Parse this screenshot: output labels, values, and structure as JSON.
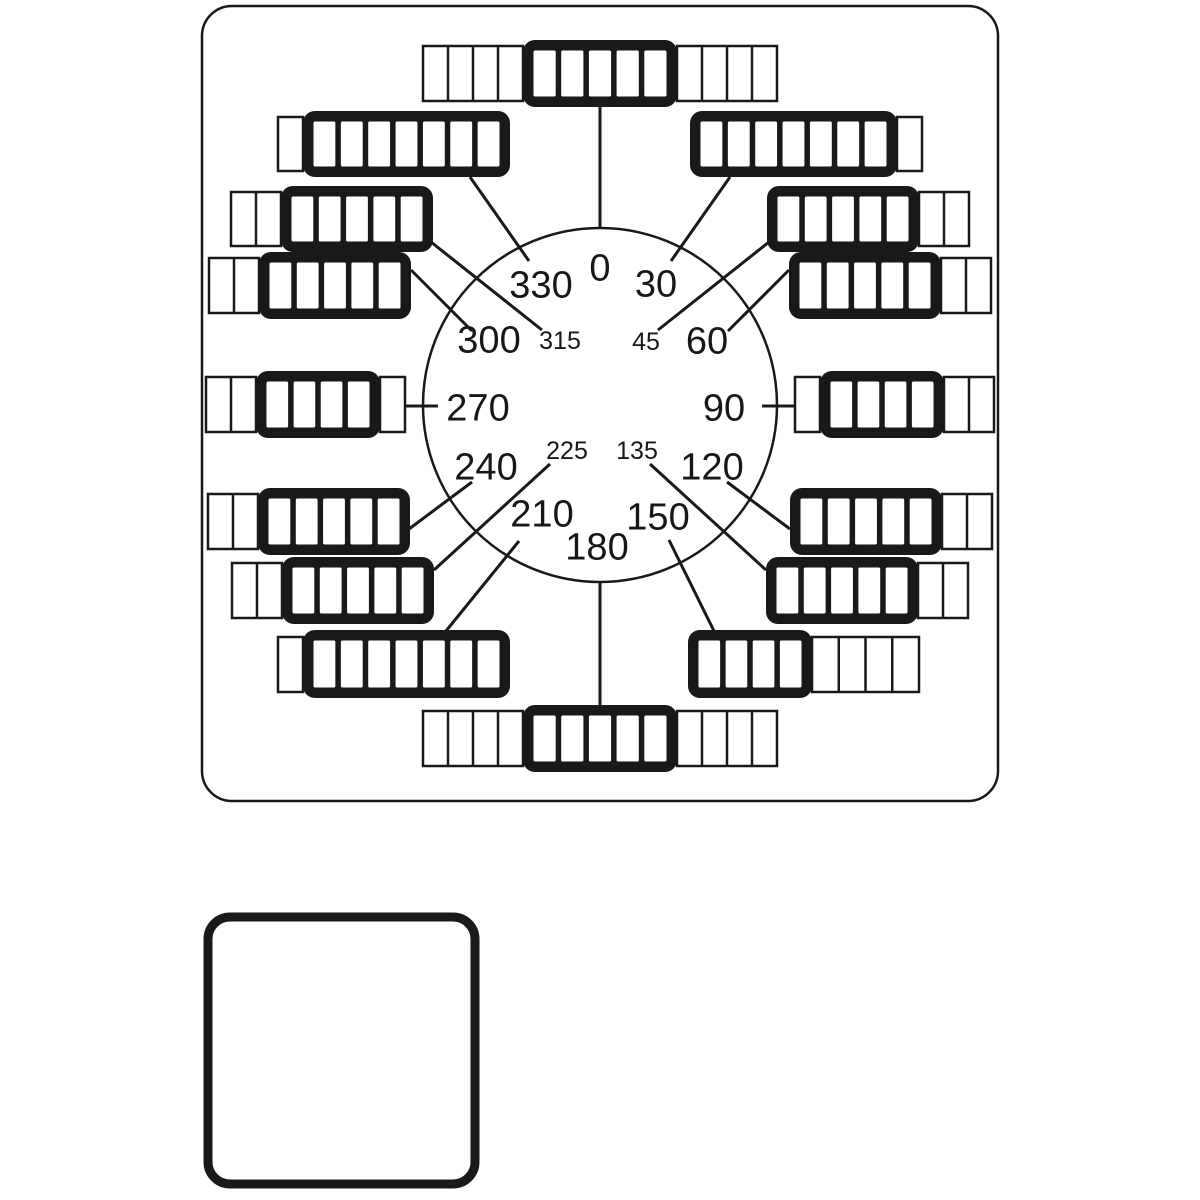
{
  "diagram": {
    "name": "rotary-cam-switch-faceplate-dial",
    "colors": {
      "ink": "#191919",
      "background": "#ffffff"
    },
    "panel": {
      "x": 202,
      "y": 6,
      "w": 796,
      "h": 795,
      "r": 30,
      "stroke_w": 2.5
    },
    "dial_circle": {
      "cx": 600,
      "cy": 405,
      "r": 177,
      "stroke_w": 2.5
    },
    "legend_square": {
      "x": 208,
      "y": 917,
      "w": 267,
      "h": 267,
      "r": 22,
      "stroke_w": 9
    },
    "positions": [
      {
        "angle": "0",
        "label": {
          "x": 600,
          "y": 267,
          "size": "large"
        },
        "line": {
          "x1": 600,
          "y1": 107,
          "x2": 600,
          "y2": 228
        },
        "segments": [
          {
            "style": "thin",
            "x": 423,
            "y": 46,
            "w": 100,
            "h": 55,
            "cells": 4
          },
          {
            "style": "thick",
            "x": 523,
            "y": 40,
            "w": 154,
            "h": 67,
            "cells": 5
          },
          {
            "style": "thin",
            "x": 677,
            "y": 46,
            "w": 100,
            "h": 55,
            "cells": 4
          }
        ]
      },
      {
        "angle": "30",
        "label": {
          "x": 656,
          "y": 283,
          "size": "large"
        },
        "line": {
          "x1": 730,
          "y1": 177,
          "x2": 671,
          "y2": 261
        },
        "segments": [
          {
            "style": "thick",
            "x": 690,
            "y": 111,
            "w": 207,
            "h": 66,
            "cells": 7
          },
          {
            "style": "thin",
            "x": 897,
            "y": 117,
            "w": 25,
            "h": 54,
            "cells": 1
          }
        ]
      },
      {
        "angle": "45",
        "label": {
          "x": 646,
          "y": 341,
          "size": "small"
        },
        "line": {
          "x1": 769,
          "y1": 242,
          "x2": 658,
          "y2": 330
        },
        "segments": [
          {
            "style": "thick",
            "x": 767,
            "y": 186,
            "w": 152,
            "h": 66,
            "cells": 5
          },
          {
            "style": "thin",
            "x": 919,
            "y": 192,
            "w": 50,
            "h": 54,
            "cells": 2
          }
        ]
      },
      {
        "angle": "60",
        "label": {
          "x": 707,
          "y": 340,
          "size": "large"
        },
        "line": {
          "x1": 789,
          "y1": 270,
          "x2": 728,
          "y2": 331
        },
        "segments": [
          {
            "style": "thick",
            "x": 789,
            "y": 252,
            "w": 152,
            "h": 67,
            "cells": 5
          },
          {
            "style": "thin",
            "x": 941,
            "y": 258,
            "w": 50,
            "h": 55,
            "cells": 2
          }
        ]
      },
      {
        "angle": "90",
        "label": {
          "x": 724,
          "y": 407,
          "size": "large"
        },
        "line": {
          "x1": 762,
          "y1": 406,
          "x2": 797,
          "y2": 406
        },
        "segments": [
          {
            "style": "thin",
            "x": 795,
            "y": 377,
            "w": 25,
            "h": 55,
            "cells": 1
          },
          {
            "style": "thick",
            "x": 820,
            "y": 371,
            "w": 124,
            "h": 67,
            "cells": 4
          },
          {
            "style": "thin",
            "x": 944,
            "y": 377,
            "w": 50,
            "h": 55,
            "cells": 2
          }
        ]
      },
      {
        "angle": "120",
        "label": {
          "x": 712,
          "y": 466,
          "size": "large"
        },
        "line": {
          "x1": 790,
          "y1": 529,
          "x2": 727,
          "y2": 482
        },
        "segments": [
          {
            "style": "thick",
            "x": 790,
            "y": 488,
            "w": 152,
            "h": 67,
            "cells": 5
          },
          {
            "style": "thin",
            "x": 942,
            "y": 494,
            "w": 50,
            "h": 55,
            "cells": 2
          }
        ]
      },
      {
        "angle": "135",
        "label": {
          "x": 637,
          "y": 450,
          "size": "small"
        },
        "line": {
          "x1": 766,
          "y1": 570,
          "x2": 650,
          "y2": 464
        },
        "segments": [
          {
            "style": "thick",
            "x": 766,
            "y": 557,
            "w": 152,
            "h": 67,
            "cells": 5
          },
          {
            "style": "thin",
            "x": 918,
            "y": 563,
            "w": 50,
            "h": 55,
            "cells": 2
          }
        ]
      },
      {
        "angle": "150",
        "label": {
          "x": 658,
          "y": 516,
          "size": "large"
        },
        "line": {
          "x1": 714,
          "y1": 631,
          "x2": 669,
          "y2": 540
        },
        "segments": [
          {
            "style": "thick",
            "x": 688,
            "y": 630,
            "w": 124,
            "h": 68,
            "cells": 4
          },
          {
            "style": "thin",
            "x": 812,
            "y": 637,
            "w": 107,
            "h": 55,
            "cells": 4
          }
        ]
      },
      {
        "angle": "180",
        "label": {
          "x": 597,
          "y": 546,
          "size": "large"
        },
        "line": {
          "x1": 600,
          "y1": 582,
          "x2": 600,
          "y2": 706
        },
        "segments": [
          {
            "style": "thin",
            "x": 423,
            "y": 711,
            "w": 100,
            "h": 55,
            "cells": 4
          },
          {
            "style": "thick",
            "x": 523,
            "y": 705,
            "w": 154,
            "h": 67,
            "cells": 5
          },
          {
            "style": "thin",
            "x": 677,
            "y": 711,
            "w": 100,
            "h": 55,
            "cells": 4
          }
        ]
      },
      {
        "angle": "210",
        "label": {
          "x": 542,
          "y": 513,
          "size": "large"
        },
        "line": {
          "x1": 446,
          "y1": 631,
          "x2": 519,
          "y2": 541
        },
        "segments": [
          {
            "style": "thin",
            "x": 278,
            "y": 637,
            "w": 25,
            "h": 55,
            "cells": 1
          },
          {
            "style": "thick",
            "x": 303,
            "y": 630,
            "w": 207,
            "h": 68,
            "cells": 7
          }
        ]
      },
      {
        "angle": "225",
        "label": {
          "x": 567,
          "y": 450,
          "size": "small"
        },
        "line": {
          "x1": 434,
          "y1": 570,
          "x2": 550,
          "y2": 464
        },
        "segments": [
          {
            "style": "thin",
            "x": 232,
            "y": 563,
            "w": 50,
            "h": 55,
            "cells": 2
          },
          {
            "style": "thick",
            "x": 282,
            "y": 557,
            "w": 152,
            "h": 67,
            "cells": 5
          }
        ]
      },
      {
        "angle": "240",
        "label": {
          "x": 486,
          "y": 466,
          "size": "large"
        },
        "line": {
          "x1": 409,
          "y1": 529,
          "x2": 472,
          "y2": 482
        },
        "segments": [
          {
            "style": "thin",
            "x": 208,
            "y": 494,
            "w": 50,
            "h": 55,
            "cells": 2
          },
          {
            "style": "thick",
            "x": 258,
            "y": 488,
            "w": 152,
            "h": 67,
            "cells": 5
          }
        ]
      },
      {
        "angle": "270",
        "label": {
          "x": 478,
          "y": 407,
          "size": "large"
        },
        "line": {
          "x1": 403,
          "y1": 406,
          "x2": 438,
          "y2": 406
        },
        "segments": [
          {
            "style": "thin",
            "x": 206,
            "y": 377,
            "w": 50,
            "h": 55,
            "cells": 2
          },
          {
            "style": "thick",
            "x": 256,
            "y": 371,
            "w": 124,
            "h": 67,
            "cells": 4
          },
          {
            "style": "thin",
            "x": 380,
            "y": 377,
            "w": 25,
            "h": 55,
            "cells": 1
          }
        ]
      },
      {
        "angle": "300",
        "label": {
          "x": 489,
          "y": 339,
          "size": "large"
        },
        "line": {
          "x1": 411,
          "y1": 270,
          "x2": 472,
          "y2": 331
        },
        "segments": [
          {
            "style": "thin",
            "x": 209,
            "y": 258,
            "w": 50,
            "h": 55,
            "cells": 2
          },
          {
            "style": "thick",
            "x": 259,
            "y": 252,
            "w": 152,
            "h": 67,
            "cells": 5
          }
        ]
      },
      {
        "angle": "315",
        "label": {
          "x": 560,
          "y": 340,
          "size": "small"
        },
        "line": {
          "x1": 431,
          "y1": 242,
          "x2": 542,
          "y2": 330
        },
        "segments": [
          {
            "style": "thin",
            "x": 231,
            "y": 192,
            "w": 50,
            "h": 54,
            "cells": 2
          },
          {
            "style": "thick",
            "x": 281,
            "y": 186,
            "w": 152,
            "h": 66,
            "cells": 5
          }
        ]
      },
      {
        "angle": "330",
        "label": {
          "x": 541,
          "y": 284,
          "size": "large"
        },
        "line": {
          "x1": 470,
          "y1": 177,
          "x2": 529,
          "y2": 261
        },
        "segments": [
          {
            "style": "thin",
            "x": 278,
            "y": 117,
            "w": 25,
            "h": 54,
            "cells": 1
          },
          {
            "style": "thick",
            "x": 303,
            "y": 111,
            "w": 207,
            "h": 66,
            "cells": 7
          }
        ]
      }
    ]
  }
}
